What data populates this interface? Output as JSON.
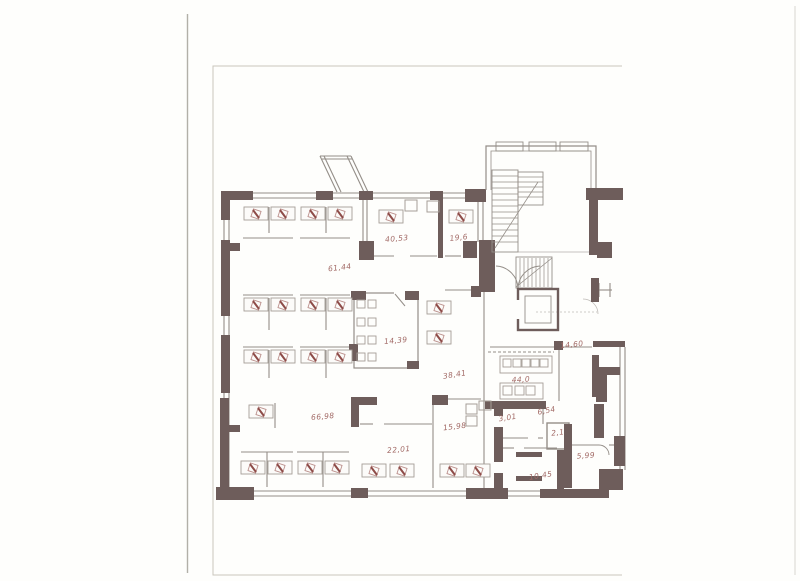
{
  "page": {
    "kind": "scanned floor plan drawing",
    "background": "#fefefc"
  },
  "drawing": {
    "wall_color": "#6e5d5b",
    "line_color": "#948e88",
    "window_color": "#aaa49e",
    "furniture_color": "#a59e97",
    "chair_accent_color": "#8e4c48",
    "chair_outline_color": "#bb908c",
    "label_color": "#a26a66",
    "frame_color": "#c9c6bd",
    "paper_edge_color": "#b2b0a8"
  },
  "rooms": [
    {
      "label": "40,53",
      "x": 397,
      "y": 241,
      "rotate": -5
    },
    {
      "label": "19,6",
      "x": 459,
      "y": 240,
      "rotate": -6
    },
    {
      "label": "61,44",
      "x": 340,
      "y": 270,
      "rotate": -7
    },
    {
      "label": "14,39",
      "x": 396,
      "y": 343,
      "rotate": -5
    },
    {
      "label": "38,41",
      "x": 455,
      "y": 377,
      "rotate": -9
    },
    {
      "label": "44,0",
      "x": 521,
      "y": 382,
      "rotate": -3
    },
    {
      "label": "14,60",
      "x": 572,
      "y": 347,
      "rotate": -6
    },
    {
      "label": "66,98",
      "x": 323,
      "y": 419,
      "rotate": -5
    },
    {
      "label": "22,01",
      "x": 399,
      "y": 452,
      "rotate": -5
    },
    {
      "label": "15,98",
      "x": 455,
      "y": 429,
      "rotate": -7
    },
    {
      "label": "3,01",
      "x": 508,
      "y": 420,
      "rotate": -9
    },
    {
      "label": "6,54",
      "x": 547,
      "y": 413,
      "rotate": -11
    },
    {
      "label": "2,1",
      "x": 558,
      "y": 435,
      "rotate": -6
    },
    {
      "label": "5,99",
      "x": 586,
      "y": 458,
      "rotate": -4
    },
    {
      "label": "10,45",
      "x": 541,
      "y": 478,
      "rotate": -9
    }
  ]
}
